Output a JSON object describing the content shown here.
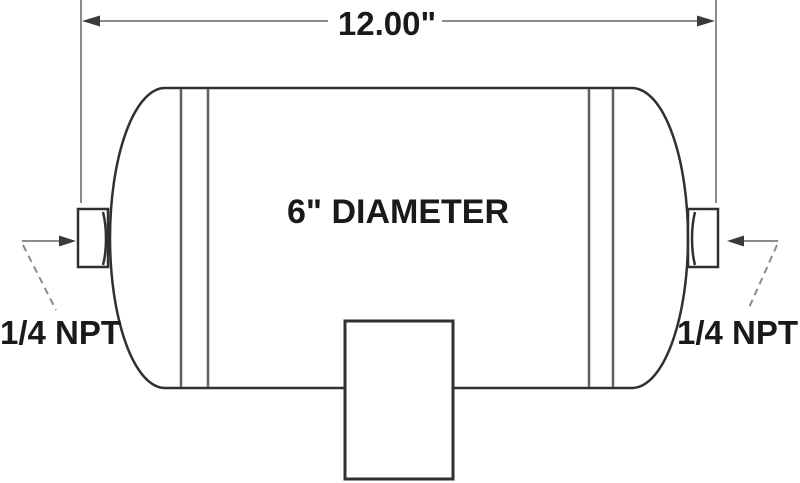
{
  "drawing": {
    "title": "air-tank-dimension-drawing",
    "length_dimension_label": "12.00\"",
    "diameter_label": "6\" DIAMETER",
    "left_port_label": "1/4 NPT",
    "right_port_label": "1/4 NPT"
  },
  "dimensions_shown": {
    "tank_length_inches": "12.00",
    "tank_diameter_inches": "6",
    "port_thread_size": "1/4 NPT",
    "port_count_shown": 2
  },
  "colors": {
    "background": "#ffffff",
    "tank_outline": "#303030",
    "weld_seam_line": "#5f5f5f",
    "dimension_line": "#8c8c8c",
    "arrowhead": "#3a3a3a",
    "label_text": "#1a1a1a"
  }
}
